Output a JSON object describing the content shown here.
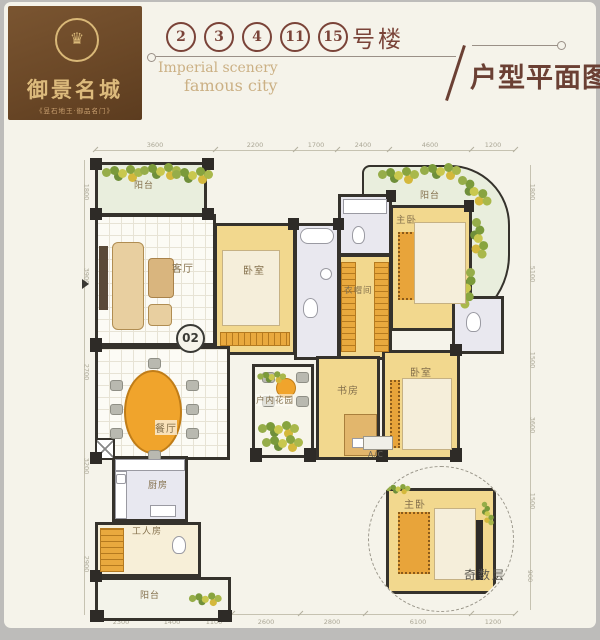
{
  "logo": {
    "name_cn": "御景名城",
    "tagline": "《昱石地王·御品名门》",
    "emblem": "♛"
  },
  "header": {
    "building_numbers": [
      "2",
      "3",
      "4",
      "11",
      "15"
    ],
    "building_suffix": "号楼",
    "en_line1": "Imperial scenery",
    "en_line2": "famous city",
    "slash": "/",
    "title_cn": "户型平面图"
  },
  "plan": {
    "unit_number": "02",
    "labels": {
      "balcony_top": "阳台",
      "living": "客厅",
      "bedroom1": "卧室",
      "cloakroom": "衣帽间",
      "master": "主卧",
      "balcony_master": "阳台",
      "dining": "餐厅",
      "garden": "户内花园",
      "study": "书房",
      "bedroom2": "卧室",
      "kitchen": "厨房",
      "maid_room": "工人房",
      "balcony_bottom": "阳台",
      "detail_master": "主卧",
      "odd_floor": "奇数层",
      "ac": "A/C"
    },
    "dims_top": [
      "3600",
      "2200",
      "1700",
      "2400",
      "4600",
      "1200"
    ],
    "dims_bottom": [
      "2300",
      "1400",
      "1100",
      "2600",
      "2800",
      "6100",
      "1200"
    ],
    "dims_right": [
      "1800",
      "5100",
      "1500",
      "3600",
      "1500",
      "900"
    ],
    "dims_left": [
      "1800",
      "3900",
      "2700",
      "3200",
      "2900"
    ]
  },
  "colors": {
    "brand_brown": "#6b4827",
    "gold": "#d9b878",
    "title_brown": "#6b4034",
    "wall": "#35322c",
    "room_yellow": "#f2d88e",
    "accent_orange": "#eda32f"
  }
}
